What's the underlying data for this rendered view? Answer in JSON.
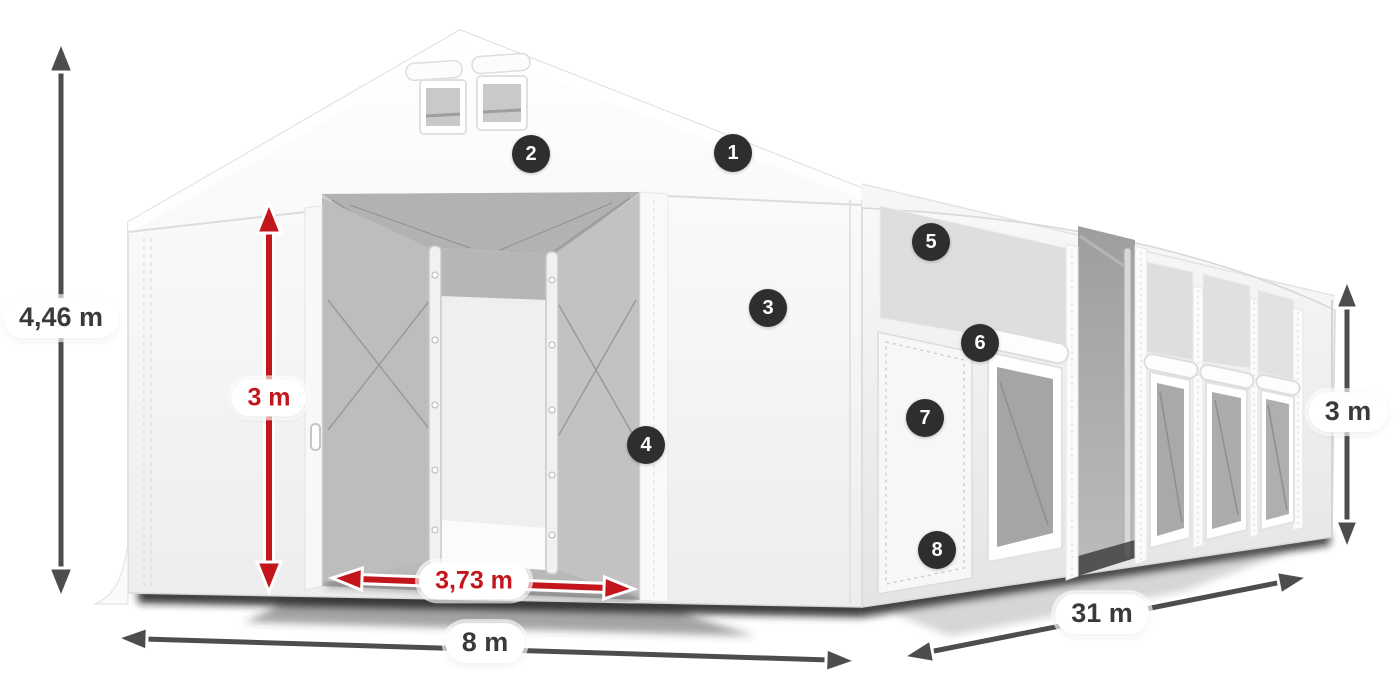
{
  "figure": {
    "kind": "product-dimensions-diagram",
    "subject": "white marquee storage tent with open gable entrance, side door and mesh windows"
  },
  "colors": {
    "background": "#ffffff",
    "accent_red": "#c3161c",
    "arrow_gray": "#4d4d4d",
    "badge_background": "#2e2e2e",
    "badge_text": "#ffffff",
    "label_background": "#ffffff",
    "label_text": "#3a3a3a",
    "tent_white": "#ffffff",
    "mesh_gray": "#a8a8a8"
  },
  "dimension_labels": {
    "total_height": {
      "value": "4,46 m",
      "color": "gray"
    },
    "entrance_height": {
      "value": "3 m",
      "color": "red"
    },
    "entrance_width": {
      "value": "3,73 m",
      "color": "red"
    },
    "tent_width": {
      "value": "8 m",
      "color": "gray"
    },
    "tent_length": {
      "value": "31 m",
      "color": "gray"
    },
    "side_height": {
      "value": "3 m",
      "color": "gray"
    }
  },
  "callouts": [
    {
      "number": "1"
    },
    {
      "number": "2"
    },
    {
      "number": "3"
    },
    {
      "number": "4"
    },
    {
      "number": "5"
    },
    {
      "number": "6"
    },
    {
      "number": "7"
    },
    {
      "number": "8"
    }
  ]
}
